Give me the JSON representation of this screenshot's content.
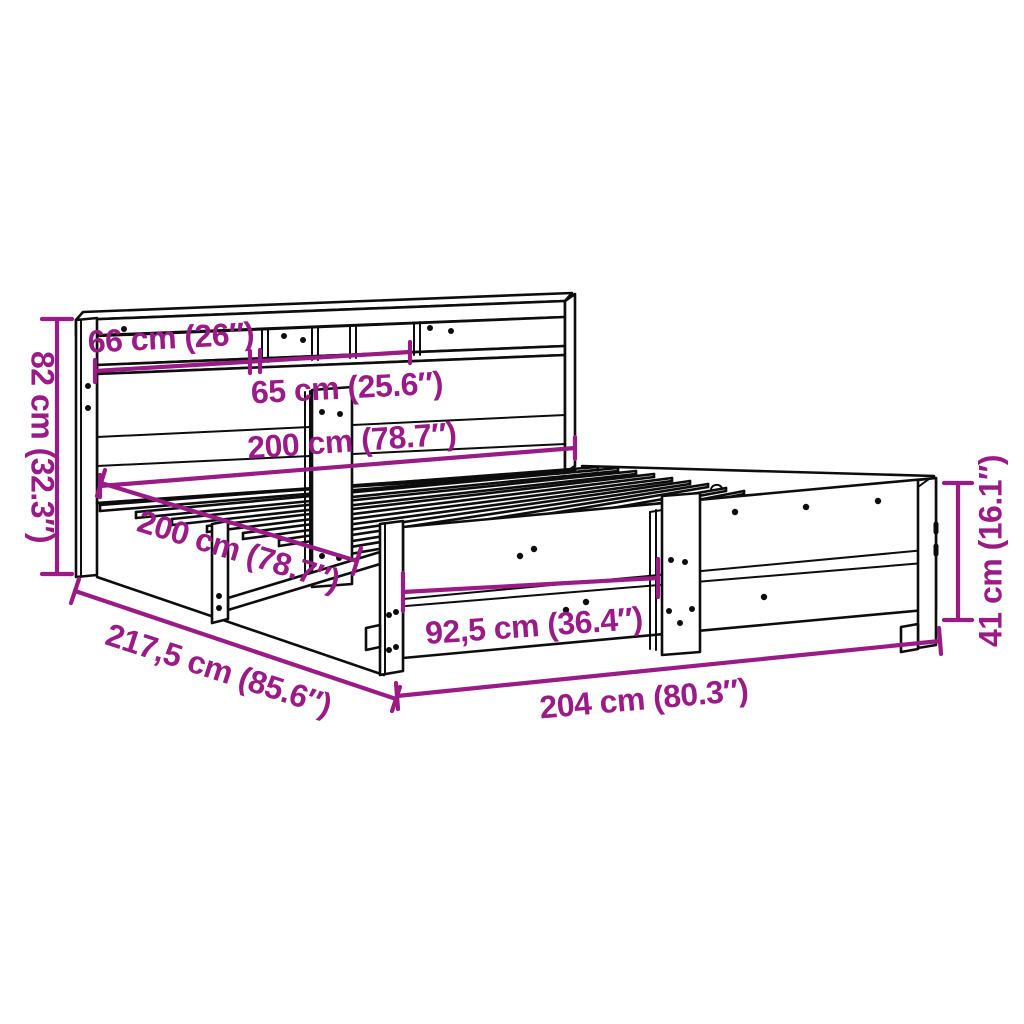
{
  "diagram": {
    "type": "product-dimension-diagram",
    "subject": "bed frame with bookcase headboard and slatted base",
    "background_color": "#ffffff",
    "line_color": "#0d0d0d",
    "dimension_color": "#9a1a86",
    "dimensions": {
      "shelf_left": {
        "label": "66 cm (26″)",
        "cm": "66",
        "inches": "26"
      },
      "shelf_center": {
        "label": "65 cm (25.6″)",
        "cm": "65",
        "inches": "25.6"
      },
      "inner_width": {
        "label": "200 cm (78.7″)",
        "cm": "200",
        "inches": "78.7"
      },
      "inner_length": {
        "label": "200 cm (78.7″)",
        "cm": "200",
        "inches": "78.7"
      },
      "headboard_height": {
        "label": "82 cm (32.3″)",
        "cm": "82",
        "inches": "32.3"
      },
      "total_length": {
        "label": "217,5 cm (85.6″)",
        "cm": "217,5",
        "inches": "85.6"
      },
      "footrail_section": {
        "label": "92,5 cm (36.4″)",
        "cm": "92,5",
        "inches": "36.4"
      },
      "total_width": {
        "label": "204 cm (80.3″)",
        "cm": "204",
        "inches": "80.3"
      },
      "side_height": {
        "label": "41 cm (16.1″)",
        "cm": "41",
        "inches": "16.1"
      }
    }
  }
}
